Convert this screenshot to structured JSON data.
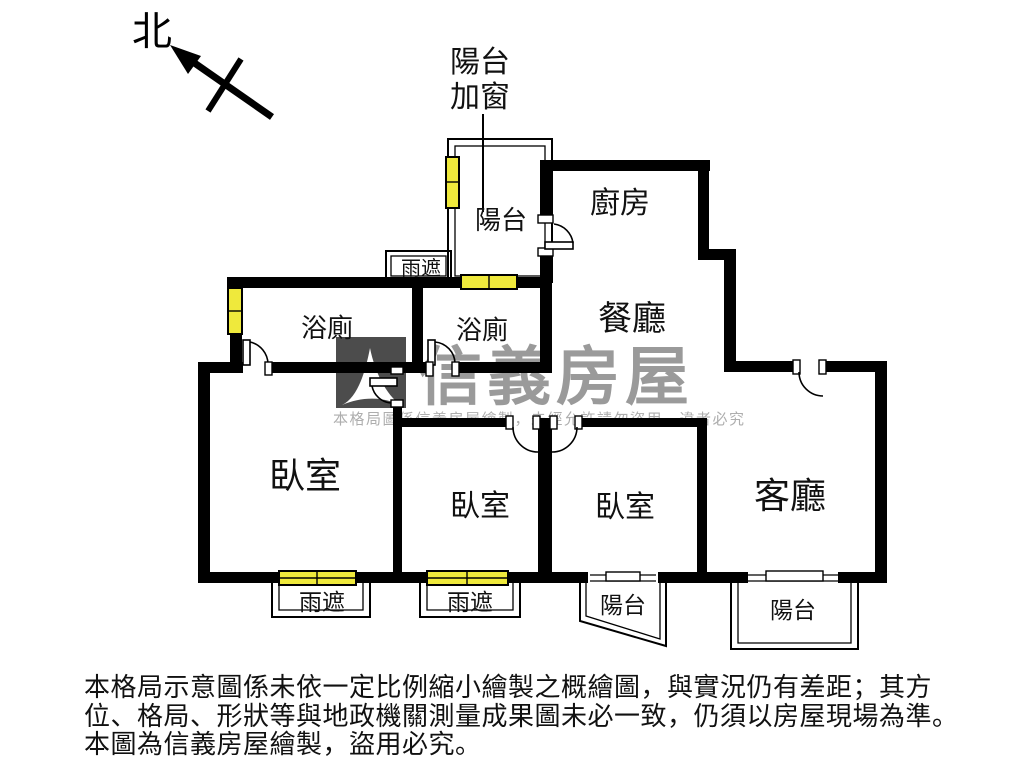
{
  "meta": {
    "type": "apartment-floor-plan",
    "brand": "信義房屋"
  },
  "compass": {
    "north": "北"
  },
  "annotations": {
    "balcony_window_l1": "陽台",
    "balcony_window_l2": "加窗"
  },
  "rooms": {
    "balcony_top": "陽台",
    "kitchen": "廚房",
    "dining": "餐廳",
    "bath_left": "浴廁",
    "bath_right": "浴廁",
    "bedroom_left": "臥室",
    "bedroom_middle": "臥室",
    "bedroom_right": "臥室",
    "living": "客廳",
    "balcony_bottom_left": "陽台",
    "balcony_bottom_right": "陽台"
  },
  "canopies": {
    "top": "雨遮",
    "bottom_left": "雨遮",
    "bottom_right": "雨遮"
  },
  "watermark": {
    "brand": "信義房屋",
    "notice": "本格局圖係信義房屋繪製，未經允許請勿盜用，違者必究"
  },
  "disclaimer": {
    "line1": "本格局示意圖係未依一定比例縮小繪製之概繪圖，與實況仍有差距；其方",
    "line2": "位、格局、形狀等與地政機關測量成果圖未必一致，仍須以房屋現場為準。",
    "line3": "本圖為信義房屋繪製，盜用必究。"
  },
  "colors": {
    "wall": "#000000",
    "window_fill": "#efe93c",
    "watermark_gray": "#9a9a9a",
    "logo_block": "#4c4c4c",
    "notice_gray": "#aeaeae"
  }
}
